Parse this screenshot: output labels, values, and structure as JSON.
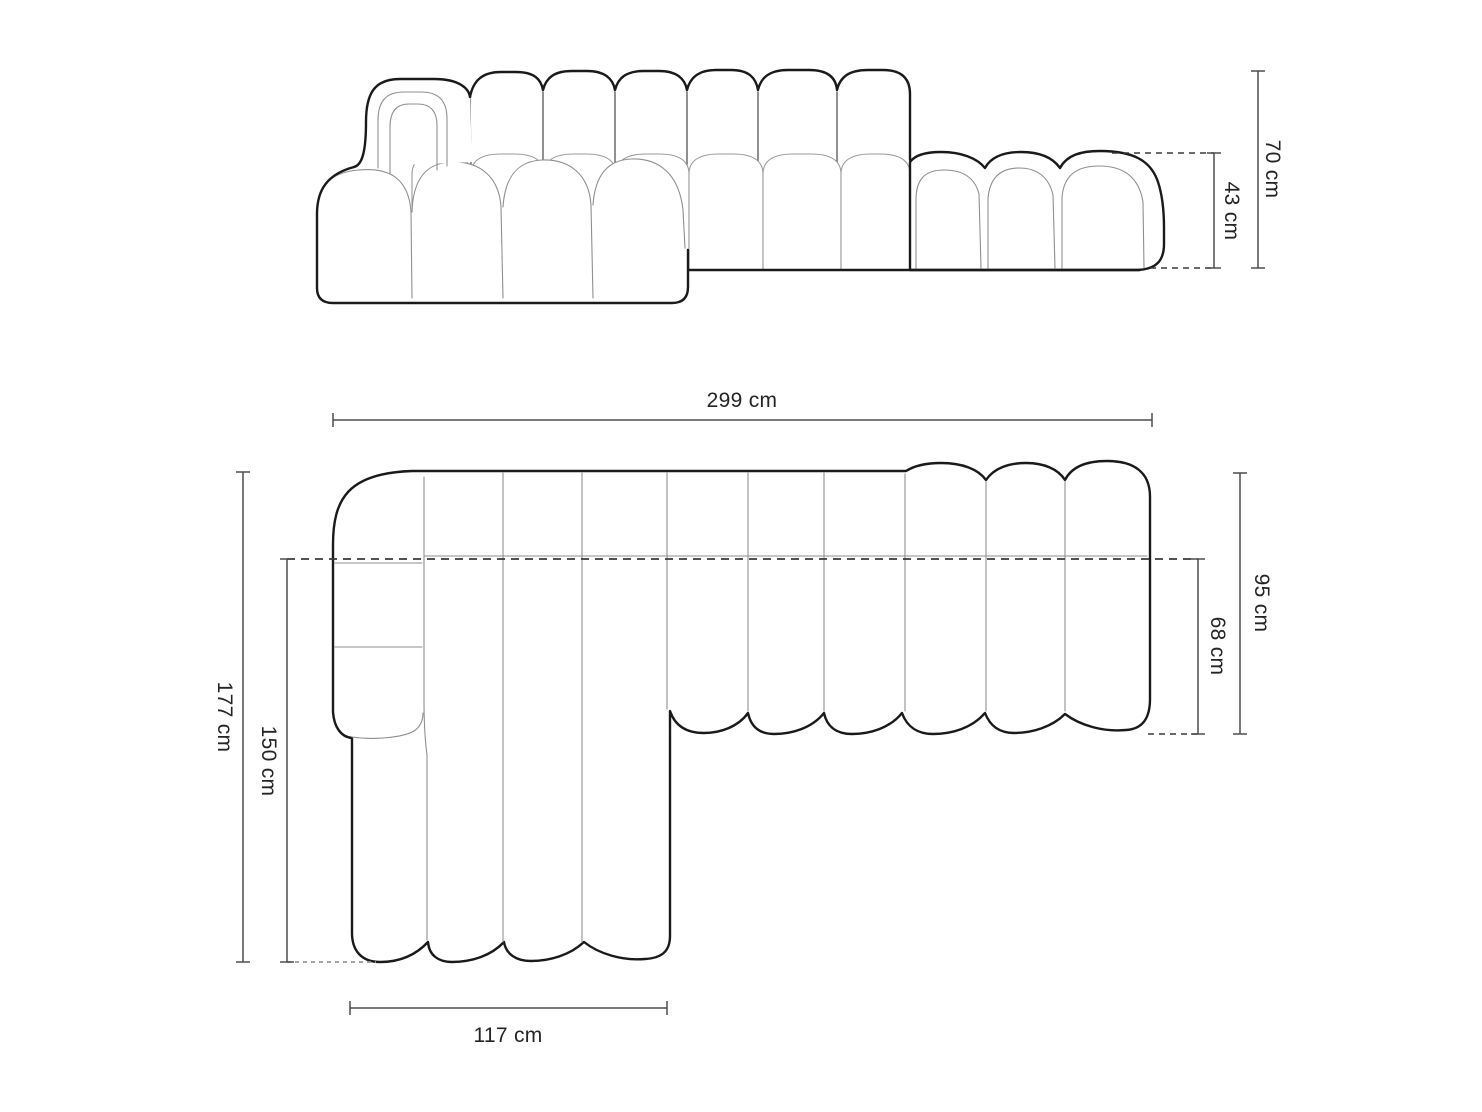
{
  "diagram": {
    "kind": "furniture dimension drawing",
    "units": "cm"
  },
  "dimensions": {
    "front_total_height": {
      "label": "70 cm",
      "value": 70
    },
    "front_seat_height": {
      "label": "43 cm",
      "value": 43
    },
    "total_width": {
      "label": "299 cm",
      "value": 299
    },
    "total_depth": {
      "label": "177 cm",
      "value": 177
    },
    "chaise_depth": {
      "label": "150 cm",
      "value": 150
    },
    "chaise_width": {
      "label": "117 cm",
      "value": 117
    },
    "side_depth": {
      "label": "95 cm",
      "value": 95
    },
    "seat_depth": {
      "label": "68 cm",
      "value": 68
    }
  },
  "colors": {
    "background": "#ffffff",
    "outline_bold": "#1a1a1a",
    "outline_thin": "#8f8f8f",
    "dimension_line": "#4d4d4d",
    "dashed_line": "#3a3a3a",
    "dotted_line_light": "#9a9a9a",
    "label_text": "#242424"
  }
}
